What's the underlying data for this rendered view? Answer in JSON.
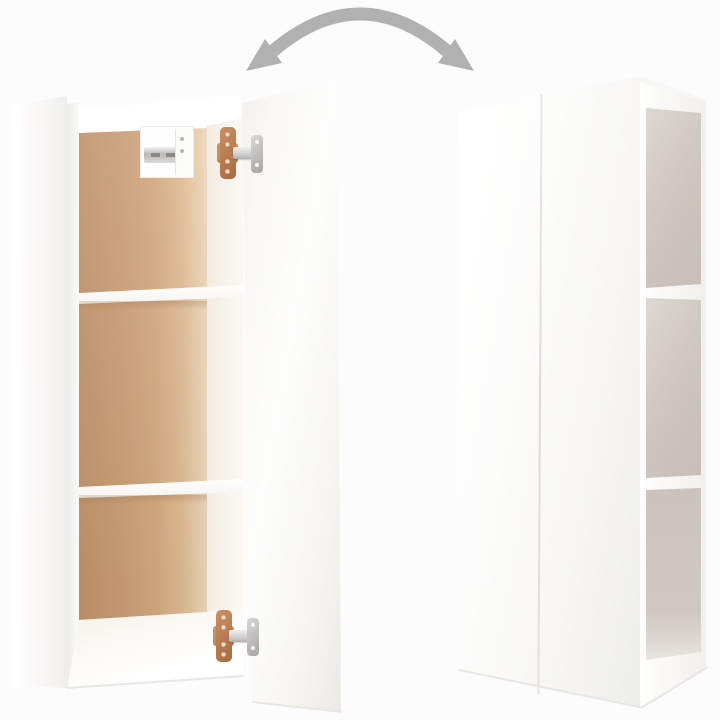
{
  "scene": {
    "type": "product-photo",
    "subject": "Two white wall-mounted cabinets, one shown with door open revealing wood-tone interior and shelves, one shown closed",
    "background_color": "#fcfcfc"
  },
  "arrow": {
    "icon": "double-curved-arrow-icon",
    "meaning": "door swings open and closed",
    "color": "#b1b1b1"
  },
  "open_cabinet": {
    "door_state": "open",
    "exterior_color": "#ffffff",
    "interior_back_color": "#c99d74",
    "shelf_count": 2,
    "compartment_count": 3,
    "hinge_count": 2,
    "hinge_plate_color": "#b5794f",
    "hinge_arm_color": "#c9c9c9",
    "wall_bracket_count": 1
  },
  "closed_cabinet": {
    "door_state": "closed",
    "exterior_color": "#ffffff",
    "side_compartment_count": 3,
    "side_compartment_color": "#cdc5be",
    "door_seam": "vertical"
  },
  "colors": {
    "background": "#fcfcfc",
    "cabinet_white": "#ffffff",
    "cabinet_white_shade": "#ededeb",
    "wood_dark": "#bf926a",
    "wood_mid": "#c99d74",
    "wood_light": "#ecd6ba",
    "interior_pale": "#f3ece1",
    "compartment_dark": "#c6beb7",
    "compartment_light": "#ddd8d2",
    "arrow_gray": "#b1b1b1",
    "hinge_copper": "#b5794f",
    "hinge_silver": "#c9c9c9",
    "edge_line": "#e9e7e4"
  }
}
